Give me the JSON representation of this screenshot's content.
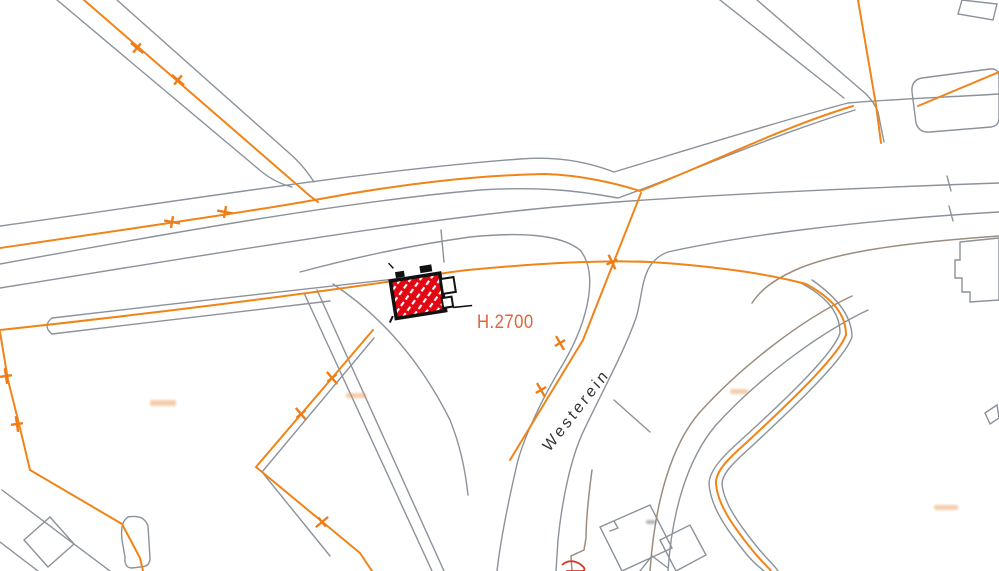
{
  "map": {
    "street_label": "Westerein",
    "parcel_label": "H.2700",
    "illegible_small_label_count": 4,
    "colors": {
      "background": "#FFFFFF",
      "utility_line_orange": "#F08418",
      "parcel_line_gray": "#8B929B",
      "road_line_brown": "#9C8C7C",
      "building_fill_red": "#E30613",
      "building_outline": "#111111",
      "parcel_label_color": "#E2633A",
      "street_label_color": "#333333"
    },
    "symbols": [
      {
        "name": "cable-junction-cross",
        "meaning": "marker on orange utility line"
      },
      {
        "name": "hatched-building",
        "meaning": "highlighted building footprint (red diagonal hatch)"
      }
    ]
  }
}
